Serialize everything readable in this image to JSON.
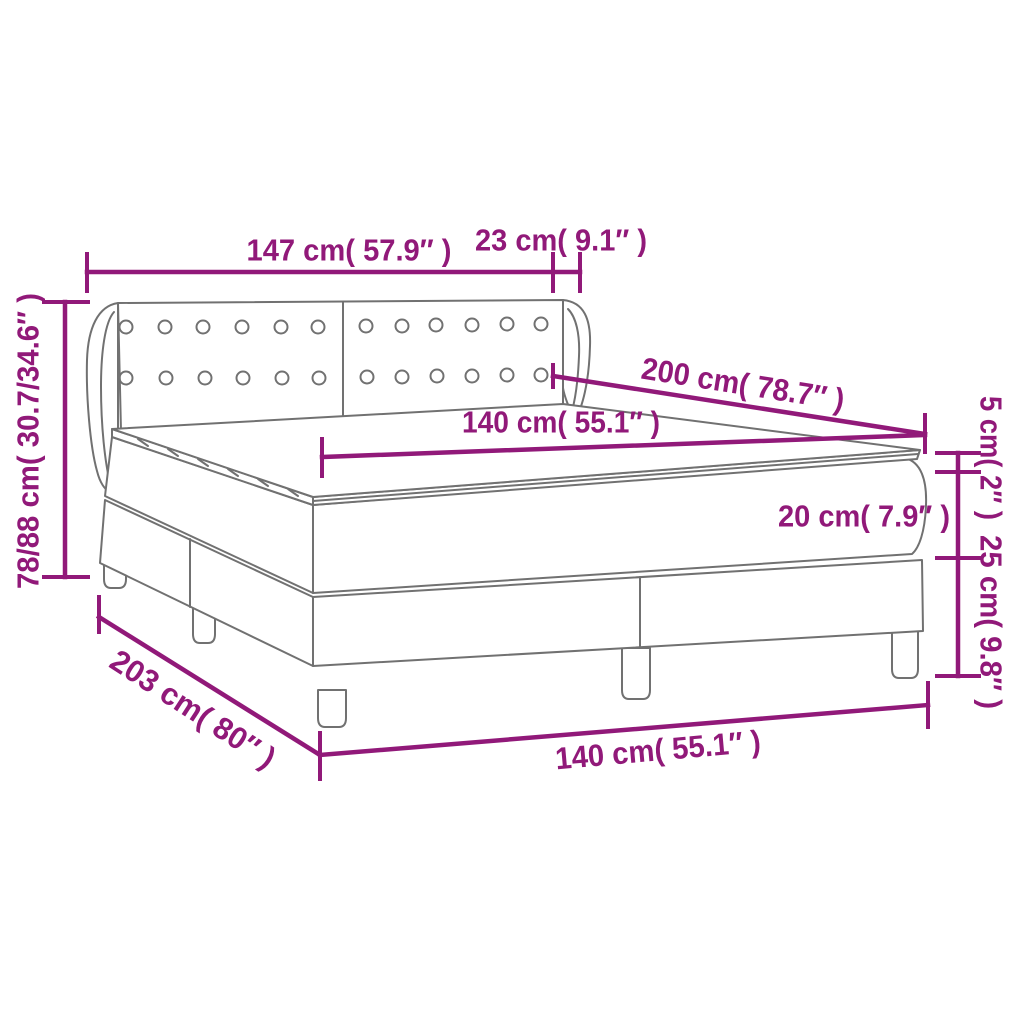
{
  "diagram": {
    "type": "product-dimension-diagram",
    "subject": "box-spring-bed-with-headboard-mattress-and-topper",
    "background_color": "#ffffff",
    "accent_color": "#911979",
    "lineart_color": "#717171",
    "dimensions": {
      "headboard_width": "147 cm( 57.9″ )",
      "wing_depth": "23 cm( 9.1″ )",
      "bed_length": "200 cm( 78.7″ )",
      "mattress_width": "140 cm( 55.1″ )",
      "topper_height": "5 cm( 2″ )",
      "mattress_height": "20 cm( 7.9″ )",
      "base_height": "25 cm( 9.8″ )",
      "total_height": "78/88 cm( 30.7/34.6″ )",
      "base_length": "203 cm( 80″ )",
      "base_width": "140 cm( 55.1″ )"
    }
  }
}
